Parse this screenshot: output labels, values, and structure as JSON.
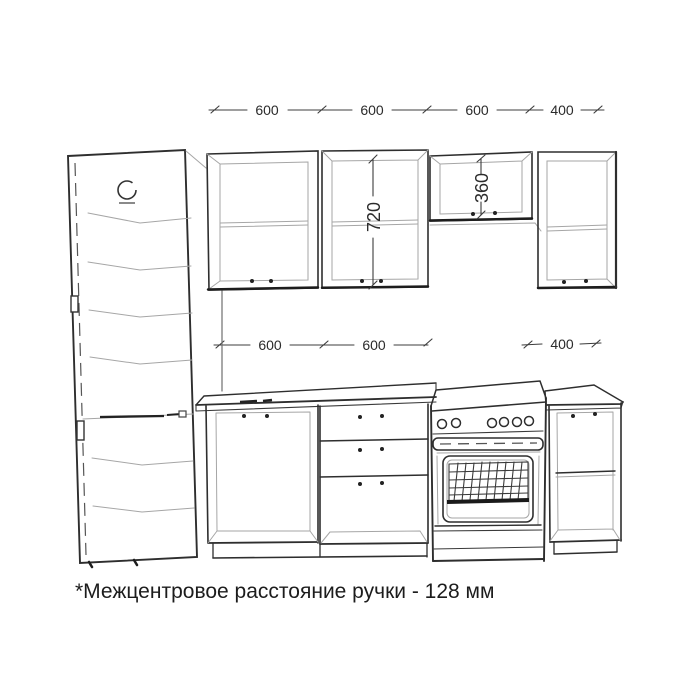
{
  "note": {
    "text": "*Межцентровое расстояние ручки - 128 мм"
  },
  "dimensions": {
    "top_row": [
      "600",
      "600",
      "600",
      "400"
    ],
    "middle_row": [
      "600",
      "600",
      "400"
    ],
    "tall_wall_cabinet_height": "720",
    "over_stove_cabinet_height": "360"
  },
  "colors": {
    "background": "#ffffff",
    "line_primary": "#2e2e2e",
    "line_secondary": "#a6a6a6",
    "text": "#1f1f1f"
  }
}
